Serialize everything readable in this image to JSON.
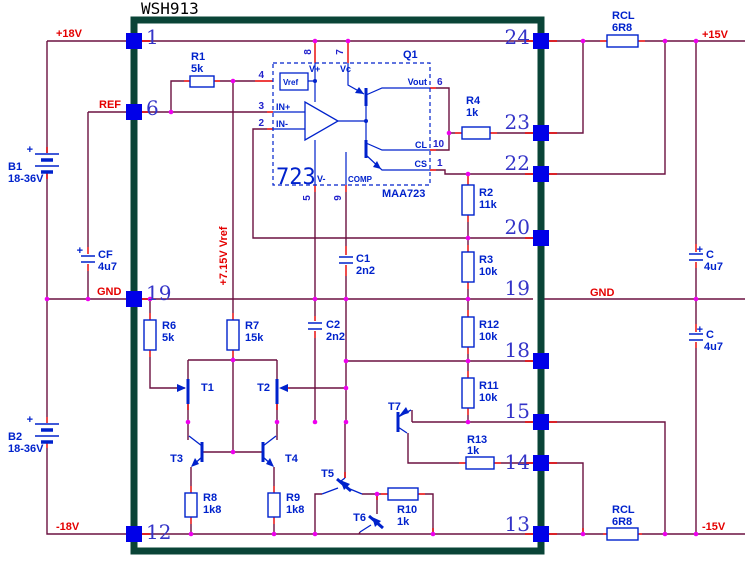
{
  "title": "WSH913",
  "labels": {
    "p18v": "+18V",
    "ref": "REF",
    "gnd_left": "GND",
    "gnd_right": "GND",
    "p15v": "+15V",
    "m15v": "-15V",
    "m18v": "-18V",
    "vref_rail": "+7.15V Vref"
  },
  "pins": {
    "left": {
      "p1": "1",
      "p6": "6",
      "p19": "19",
      "p12": "12"
    },
    "right": {
      "p24": "24",
      "p23": "23",
      "p22": "22",
      "p20": "20",
      "p19": "19",
      "p18": "18",
      "p15": "15",
      "p14": "14",
      "p13": "13"
    }
  },
  "ic": {
    "designator": "Q1",
    "big": "723",
    "part": "MAA723",
    "vref": "Vref",
    "vplus": "V+",
    "vc": "Vc",
    "vminus": "V-",
    "comp": "COMP",
    "in_plus": "IN+",
    "in_minus": "IN-",
    "vout": "Vout",
    "cl": "CL",
    "cs": "CS",
    "pin_numbers": {
      "n1": "1",
      "n2": "2",
      "n3": "3",
      "n4": "4",
      "n5": "5",
      "n6": "6",
      "n7": "7",
      "n8": "8",
      "n9": "9",
      "n10": "10"
    }
  },
  "components": {
    "r1": {
      "name": "R1",
      "value": "5k"
    },
    "r2": {
      "name": "R2",
      "value": "11k"
    },
    "r3": {
      "name": "R3",
      "value": "10k"
    },
    "r4": {
      "name": "R4",
      "value": "1k"
    },
    "r6": {
      "name": "R6",
      "value": "5k"
    },
    "r7": {
      "name": "R7",
      "value": "15k"
    },
    "r8": {
      "name": "R8",
      "value": "1k8"
    },
    "r9": {
      "name": "R9",
      "value": "1k8"
    },
    "r10": {
      "name": "R10",
      "value": "1k"
    },
    "r11": {
      "name": "R11",
      "value": "10k"
    },
    "r12": {
      "name": "R12",
      "value": "10k"
    },
    "r13": {
      "name": "R13",
      "value": "1k"
    },
    "rcl_top": {
      "name": "RCL",
      "value": "6R8"
    },
    "rcl_bottom": {
      "name": "RCL",
      "value": "6R8"
    },
    "c1": {
      "name": "C1",
      "value": "2n2"
    },
    "c2": {
      "name": "C2",
      "value": "2n2"
    },
    "c_top": {
      "plus": "+",
      "name": "C",
      "value": "4u7"
    },
    "c_bottom": {
      "plus": "+",
      "name": "C",
      "value": "4u7"
    },
    "cf": {
      "plus": "+",
      "name": "CF",
      "value": "4u7"
    },
    "b1": {
      "plus": "+",
      "name": "B1",
      "value": "18-36V"
    },
    "b2": {
      "plus": "+",
      "name": "B2",
      "value": "18-36V"
    },
    "t1": {
      "name": "T1"
    },
    "t2": {
      "name": "T2"
    },
    "t3": {
      "name": "T3"
    },
    "t4": {
      "name": "T4"
    },
    "t5": {
      "name": "T5"
    },
    "t6": {
      "name": "T6"
    },
    "t7": {
      "name": "T7"
    }
  }
}
